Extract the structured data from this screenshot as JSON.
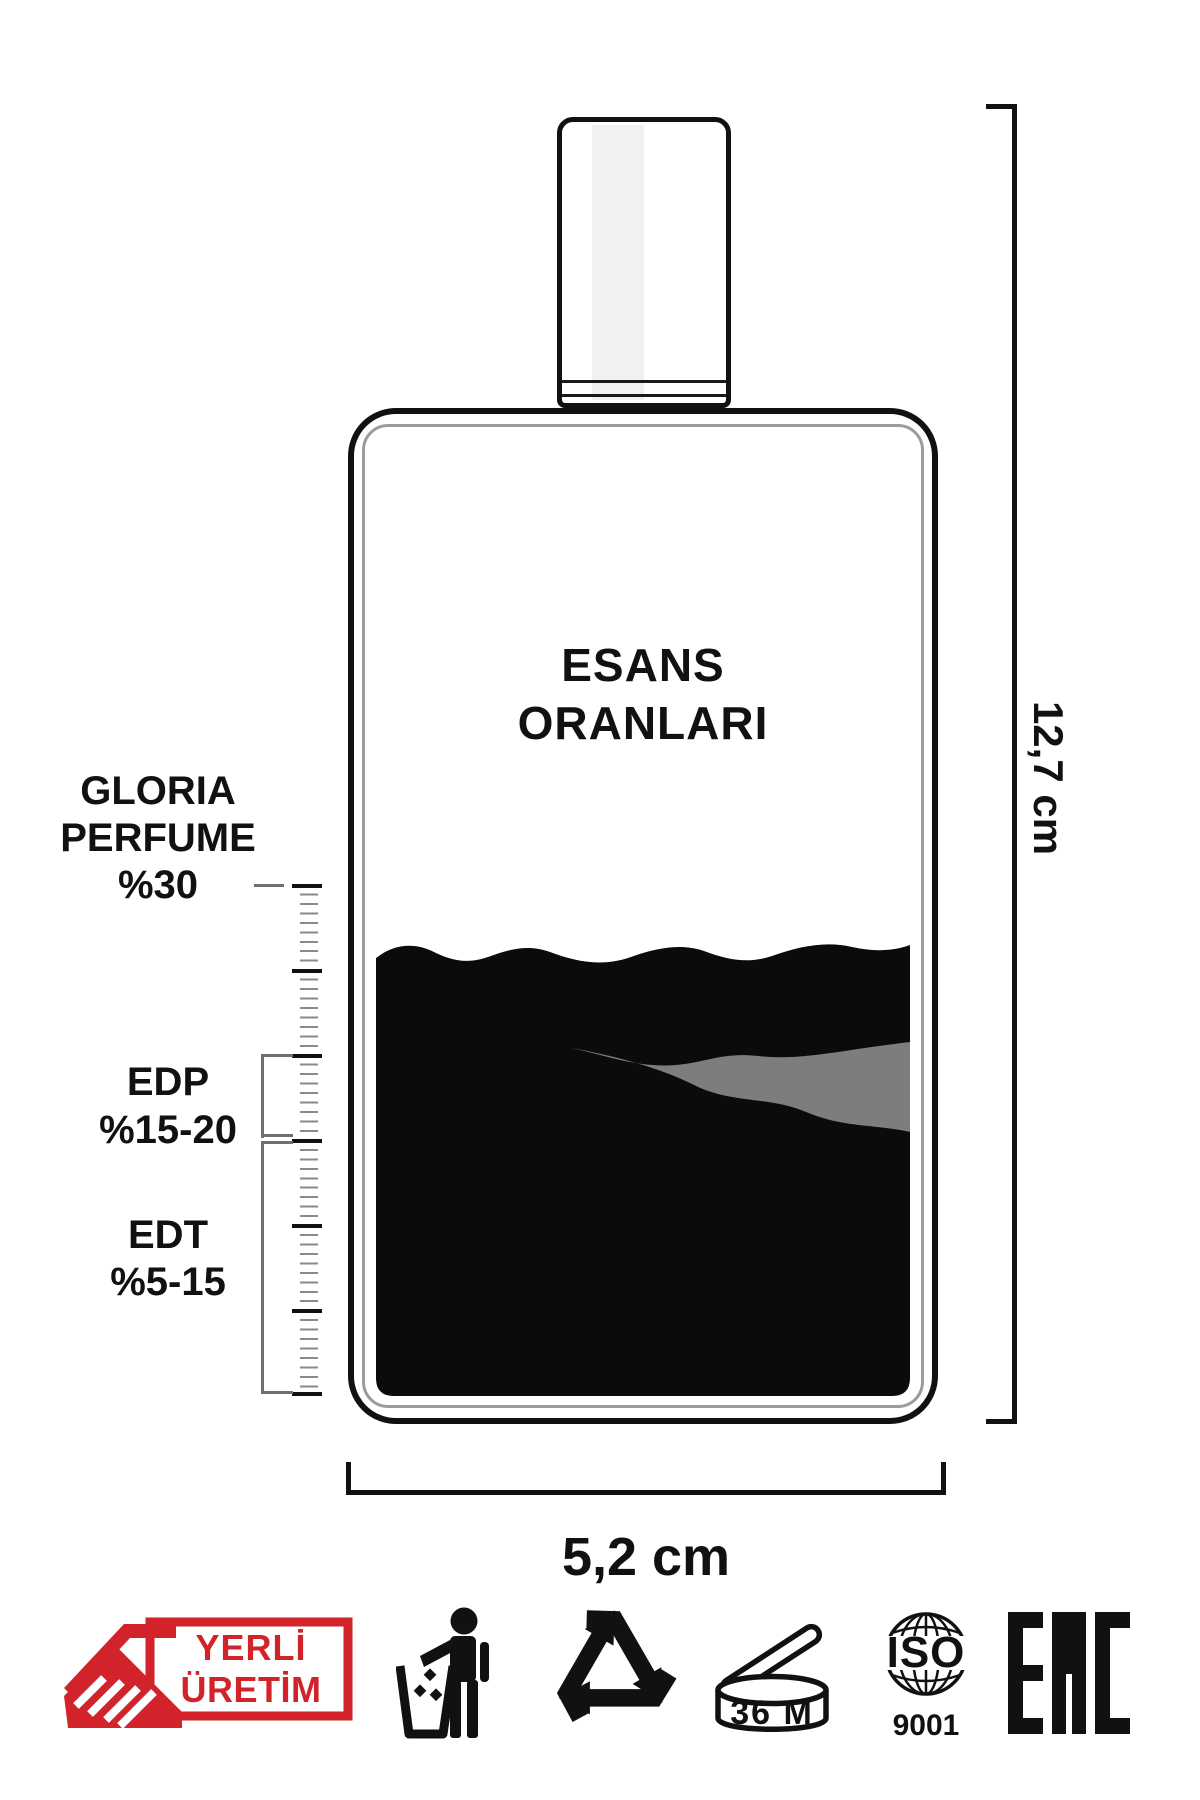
{
  "page": {
    "background": "#ffffff"
  },
  "colors": {
    "ink": "#111111",
    "liquid": "#0b0b0d",
    "streak": "#7d7d7d",
    "inner_border": "#9c9c9c",
    "tick_minor": "#8a8a8a",
    "bracket": "#6f6f6f",
    "badge_red": "#d2232a",
    "cap_stripe": "#f1f1f1"
  },
  "title": {
    "line1": "ESANS",
    "line2": "ORANLARI"
  },
  "scale": {
    "gloria": {
      "line1": "GLORIA",
      "line2": "PERFUME",
      "line3": "%30"
    },
    "edp": {
      "line1": "EDP",
      "line2": "%15-20"
    },
    "edt": {
      "line1": "EDT",
      "line2": "%5-15"
    }
  },
  "dimensions": {
    "height": "12,7 cm",
    "width": "5,2 cm"
  },
  "badge": {
    "line1": "YERLİ",
    "line2": "ÜRETİM"
  },
  "icons": {
    "tidyman": "tidyman-icon",
    "recycle": "recycle-icon",
    "period_after_opening_label": "36 M",
    "iso_line1": "ISO",
    "iso_line2": "9001",
    "eac_text": "EAC"
  }
}
